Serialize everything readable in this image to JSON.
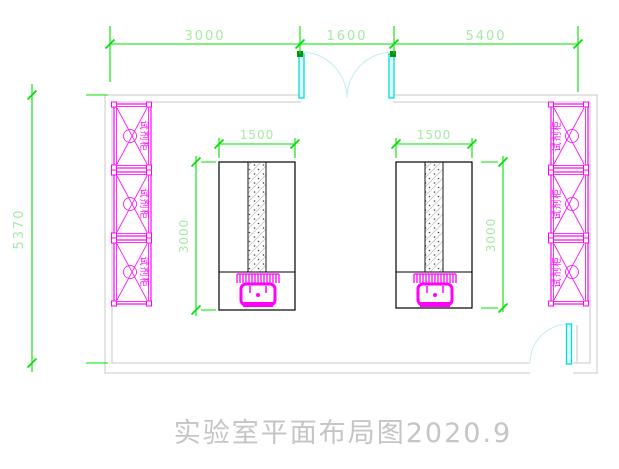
{
  "drawing": {
    "title": "实验室平面布局图2020.9",
    "cabinet_label": "试剂柜",
    "dims": {
      "top_left": "3000",
      "top_middle": "1600",
      "top_right": "5400",
      "room_height": "5370",
      "bench_width": "1500",
      "bench_height": "3000"
    },
    "colors": {
      "dimension_line": "#00e200",
      "dimension_text": "#a6e9a6",
      "cabinet": "#ff00ff",
      "door_leaf": "#00dcdc",
      "door_arc": "#bfeef2",
      "wall": "#c9c9c9",
      "bench_outline": "#000000",
      "title_text": "#c5c5c5",
      "background": "#ffffff"
    }
  }
}
